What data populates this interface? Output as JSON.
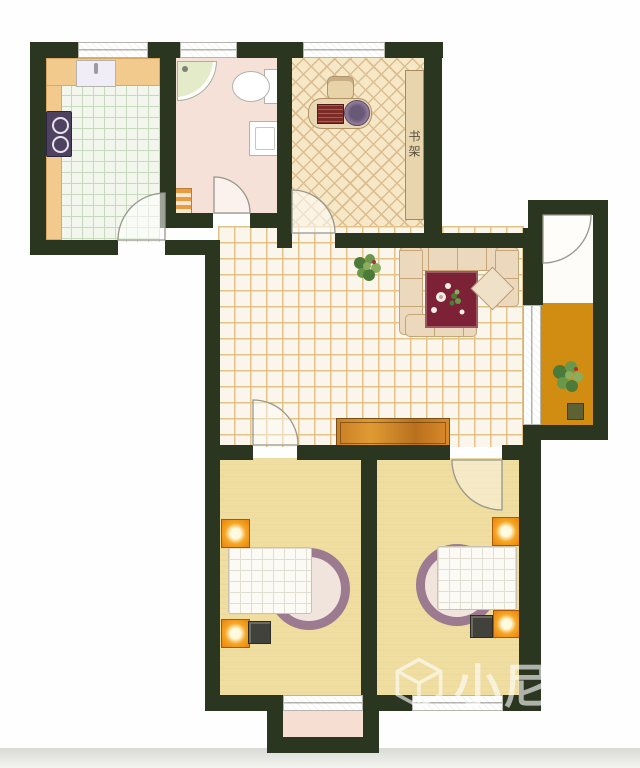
{
  "document": {
    "kind": "apartment floor plan (scanned color image)"
  },
  "watermark": {
    "logo": "cube-logo",
    "text": "小尼宅配"
  },
  "labels": {
    "bookshelf": "书架"
  },
  "rooms": [
    {
      "name": "kitchen"
    },
    {
      "name": "bathroom"
    },
    {
      "name": "study"
    },
    {
      "name": "living-dining-hall"
    },
    {
      "name": "balcony"
    },
    {
      "name": "bedroom-left"
    },
    {
      "name": "bedroom-right"
    },
    {
      "name": "bay-window"
    }
  ],
  "furniture_symbols": [
    "stove",
    "kitchen-sink",
    "counter",
    "shower",
    "toilet",
    "wash-basin",
    "radiator",
    "desk",
    "computer-monitor",
    "keyboard",
    "desk-chair",
    "bookshelf",
    "sofa",
    "rug",
    "coffee-table",
    "plant",
    "tv-cabinet",
    "bed",
    "bed-round-end",
    "nightstand",
    "lamp",
    "stool",
    "door-arc",
    "window"
  ],
  "colors": {
    "wall": "#2a361f",
    "living_tile_bg": "#fbf6ec",
    "living_tile_line": "#e3c287",
    "kitchen_tile_bg": "#f2f6ec",
    "kitchen_tile_line": "#c8dabe",
    "counter": "#f3ca8e",
    "counter_edge": "#d9a963",
    "bath_floor": "#f5e1d8",
    "study_floor": "#f6e7c6",
    "study_line": "#dcbd90",
    "bedroom_floor": "#f0dda0",
    "bay_floor": "#f7ded2",
    "balcony_floor": "#d08d12",
    "strip_white": "#fdfcf8",
    "rug": "#7c2136",
    "sofa": "#ecd9bd",
    "sofa_edge": "#c7a474",
    "cabinet": "#d98a2b",
    "nightstand": "#ea810f",
    "stove": "#4f4260",
    "bed_ring": "#9c7b90",
    "fixture_edge": "#b3b3ab",
    "door_arc": "#97978c",
    "window_line": "#b5b5ad",
    "plant_dark": "#4c7a38",
    "plant_mid": "#69984a",
    "plant_light": "#8aad5e"
  }
}
